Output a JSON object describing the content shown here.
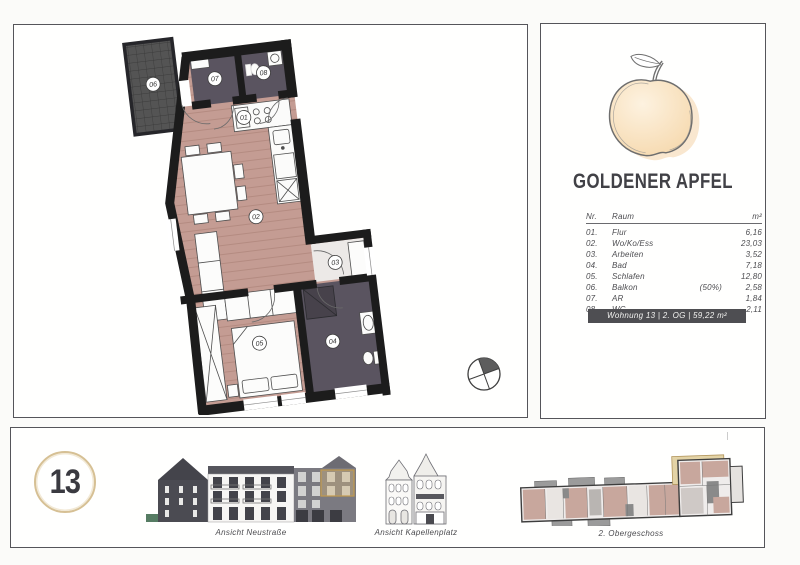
{
  "page": {
    "background": "#fbfbf9",
    "panel_border": "#55555a",
    "accent_gold": "#d6c094"
  },
  "plan": {
    "labels": [
      "01",
      "02",
      "03",
      "04",
      "05",
      "06",
      "07",
      "08"
    ],
    "colors": {
      "wood_floor": "#c49c93",
      "dark_floor": "#5a5460",
      "wall": "#1c1c1c",
      "balcony": "#545454"
    }
  },
  "info": {
    "title": "GOLDENER APFEL",
    "table": {
      "col_nr": "Nr.",
      "col_raum": "Raum",
      "col_area": "m²",
      "rows": [
        {
          "nr": "01.",
          "raum": "Flur",
          "note": "",
          "area": "6,16"
        },
        {
          "nr": "02.",
          "raum": "Wo/Ko/Ess",
          "note": "",
          "area": "23,03"
        },
        {
          "nr": "03.",
          "raum": "Arbeiten",
          "note": "",
          "area": "3,52"
        },
        {
          "nr": "04.",
          "raum": "Bad",
          "note": "",
          "area": "7,18"
        },
        {
          "nr": "05.",
          "raum": "Schlafen",
          "note": "",
          "area": "12,80"
        },
        {
          "nr": "06.",
          "raum": "Balkon",
          "note": "(50%)",
          "area": "2,58"
        },
        {
          "nr": "07.",
          "raum": "AR",
          "note": "",
          "area": "1,84"
        },
        {
          "nr": "08.",
          "raum": "WC",
          "note": "",
          "area": "2,11"
        }
      ]
    },
    "badge": "Wohnung 13 | 2. OG | 59,22 m²"
  },
  "footer": {
    "unit_number": "13",
    "label_neustrasse": "Ansicht Neustraße",
    "label_kapellenplatz": "Ansicht Kapellenplatz",
    "label_site": "2. Obergeschoss"
  }
}
